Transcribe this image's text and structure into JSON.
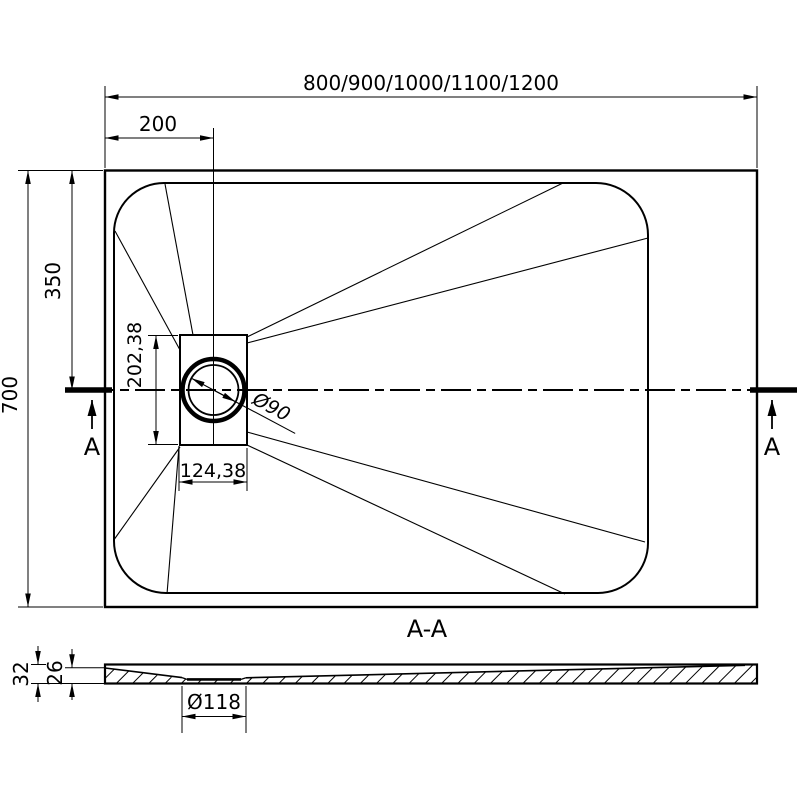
{
  "plan_view": {
    "width_label": "800/900/1000/1100/1200",
    "drain_offset_label": "200",
    "depth_label": "700",
    "drain_center_label": "350",
    "drain_box_height_label": "202,38",
    "drain_box_width_label": "124,38",
    "drain_diameter_label": "Ø90",
    "section_cut_label_left": "A",
    "section_cut_label_right": "A"
  },
  "section_view": {
    "title": "A-A",
    "overall_height_label": "32",
    "inner_depth_label": "26",
    "drain_recess_label": "Ø118"
  },
  "colors": {
    "line": "#000000",
    "background": "#ffffff"
  }
}
